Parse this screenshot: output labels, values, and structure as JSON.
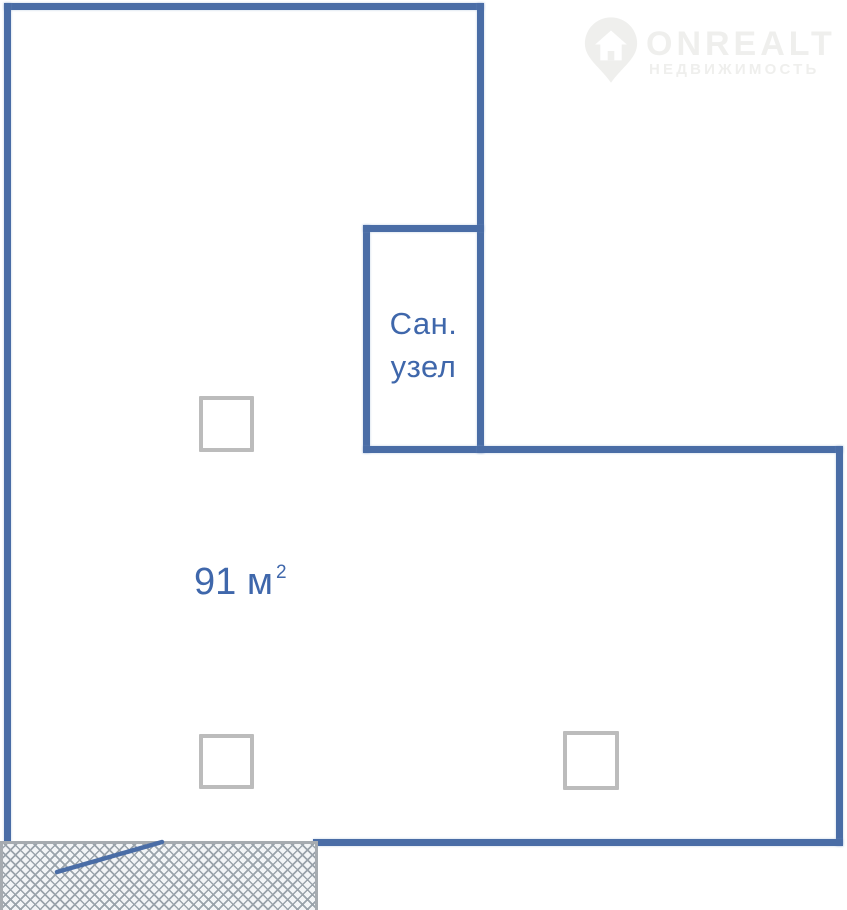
{
  "watermark": {
    "brand": "ONREALT",
    "subtitle": "НЕДВИЖИМОСТЬ",
    "icon": "house-pin-icon"
  },
  "plan": {
    "area_value": "91 м",
    "area_superscript": "2",
    "bathroom_label": [
      "Сан.",
      "узел"
    ]
  },
  "colors": {
    "wall": "#4a6da6",
    "text": "#3f67ab",
    "column_border": "#bcbcbc",
    "hatch_line": "#9aa3ab",
    "hatch_bg": "#f3f5f7",
    "hatch_border": "#a6abb0",
    "watermark": "#efefed",
    "background": "#ffffff"
  }
}
